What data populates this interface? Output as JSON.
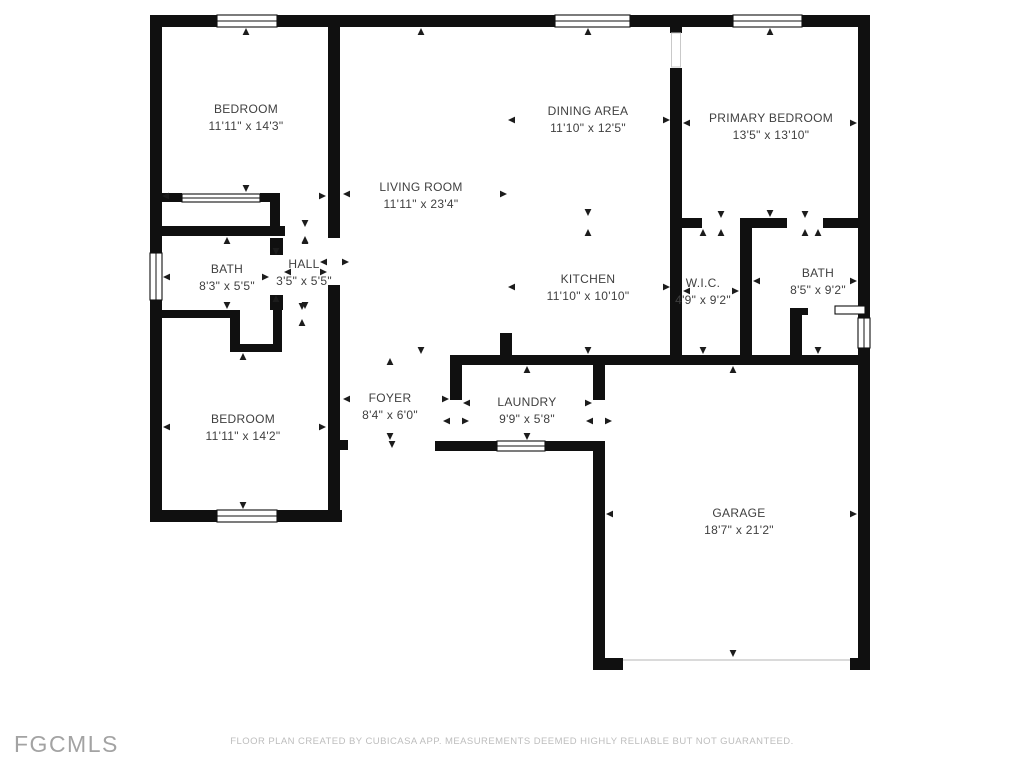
{
  "floor_plan": {
    "rooms": [
      {
        "id": "bedroom-top-left",
        "name": "BEDROOM",
        "dims": "11'11\" x 14'3\""
      },
      {
        "id": "dining-area",
        "name": "DINING AREA",
        "dims": "11'10\" x 12'5\""
      },
      {
        "id": "primary-bedroom",
        "name": "PRIMARY BEDROOM",
        "dims": "13'5\" x 13'10\""
      },
      {
        "id": "living-room",
        "name": "LIVING ROOM",
        "dims": "11'11\" x 23'4\""
      },
      {
        "id": "bath-left",
        "name": "BATH",
        "dims": "8'3\" x 5'5\""
      },
      {
        "id": "hall",
        "name": "HALL",
        "dims": "3'5\" x 5'5\""
      },
      {
        "id": "kitchen",
        "name": "KITCHEN",
        "dims": "11'10\" x 10'10\""
      },
      {
        "id": "wic",
        "name": "W.I.C.",
        "dims": "4'9\" x 9'2\""
      },
      {
        "id": "bath-right",
        "name": "BATH",
        "dims": "8'5\" x 9'2\""
      },
      {
        "id": "bedroom-bottom-left",
        "name": "BEDROOM",
        "dims": "11'11\" x 14'2\""
      },
      {
        "id": "foyer",
        "name": "FOYER",
        "dims": "8'4\" x 6'0\""
      },
      {
        "id": "laundry",
        "name": "LAUNDRY",
        "dims": "9'9\" x 5'8\""
      },
      {
        "id": "garage",
        "name": "GARAGE",
        "dims": "18'7\" x 21'2\""
      }
    ],
    "footer": {
      "logo": "FGCMLS",
      "disclaimer": "FLOOR PLAN CREATED BY CUBICASA APP. MEASUREMENTS DEEMED HIGHLY RELIABLE BUT NOT GUARANTEED."
    },
    "colors": {
      "wall": "#101010",
      "label_text": "#3f3f3f",
      "logo_text": "#a3a3a3",
      "disclaimer_text": "#bdbdbd",
      "background": "#ffffff"
    }
  }
}
